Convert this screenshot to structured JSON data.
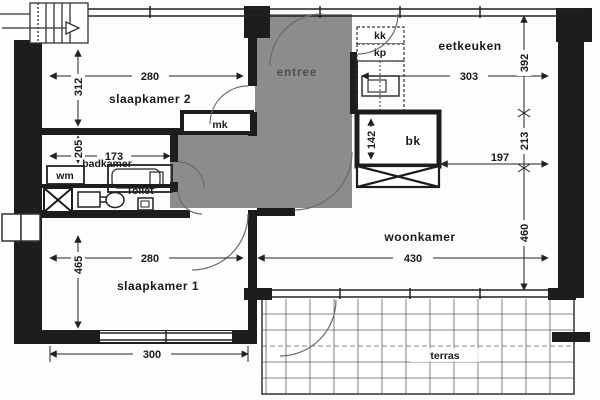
{
  "floorplan": {
    "labels": {
      "slaapkamer2": "slaapkamer 2",
      "slaapkamer1": "slaapkamer 1",
      "badkamer": "badkamer",
      "toilet": "Toilet",
      "entree": "entree",
      "eetkeuken": "eetkeuken",
      "woonkamer": "woonkamer",
      "terras": "terras",
      "wm": "wm",
      "mk": "mk",
      "bk": "bk",
      "kk": "kk",
      "kp": "kp"
    },
    "dimensions_cm": {
      "slaapkamer2_width": "280",
      "slaapkamer2_depth": "312",
      "badkamer_width": "173",
      "badkamer_depth": "205",
      "slaapkamer1_width": "280",
      "slaapkamer1_depth": "465",
      "slaapkamer1_window": "300",
      "eetkeuken_width": "303",
      "eetkeuken_depth": "392",
      "passage_depth": "213",
      "passage_width": "197",
      "woonkamer_width": "430",
      "woonkamer_depth": "460",
      "bk_depth": "142"
    },
    "colors": {
      "wall": "#1d1d1d",
      "entree_fill": "#8c8c8c",
      "line": "#222222"
    }
  }
}
